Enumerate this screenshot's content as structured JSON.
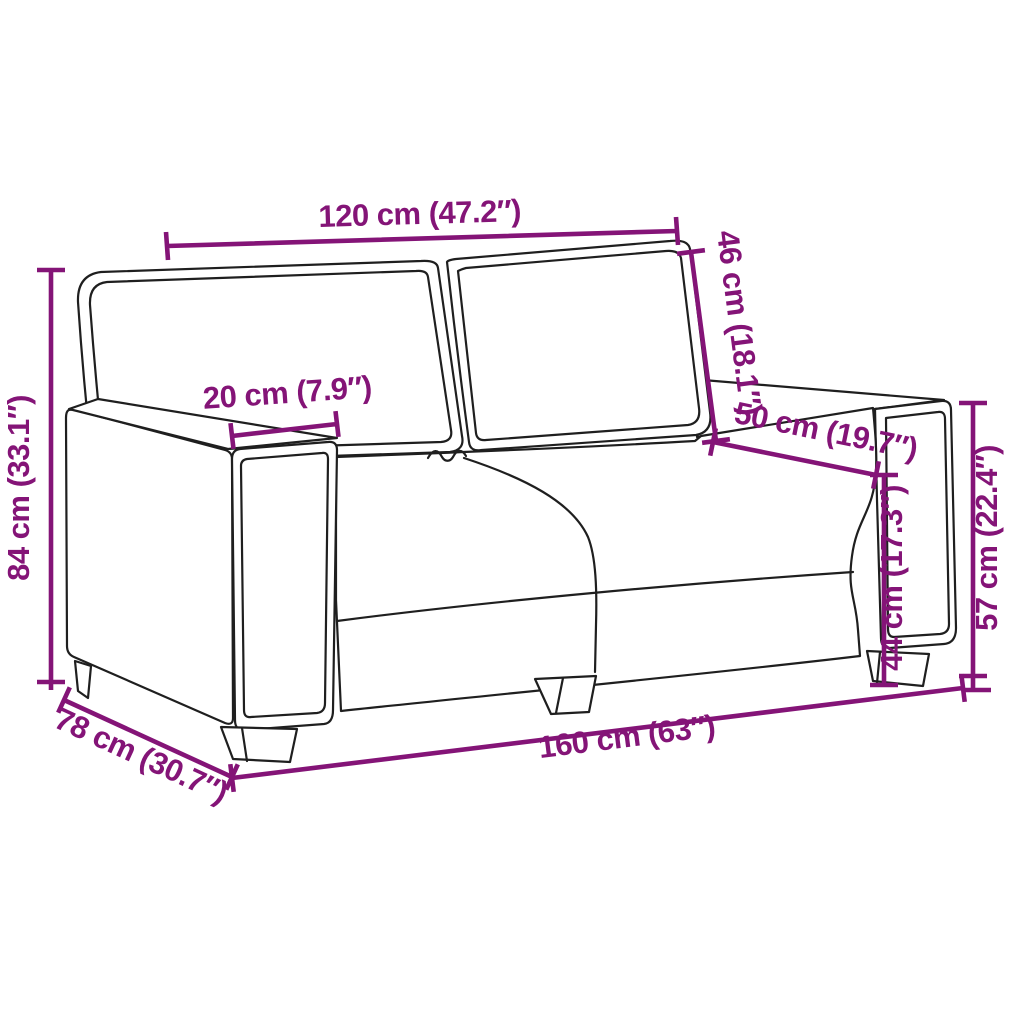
{
  "figure": {
    "subject": "two-seater sofa outline drawing with dimension annotations",
    "colors": {
      "background": "#ffffff",
      "outline": "#1f1f1f",
      "dimension_accent": "#841477"
    }
  },
  "dims": {
    "back_width": {
      "label": "120 cm (47.2″)",
      "cm": 120,
      "inch": 47.2
    },
    "back_height": {
      "label": "46 cm (18.1″)",
      "cm": 46,
      "inch": 18.1
    },
    "armrest_width": {
      "label": "20 cm (7.9″)",
      "cm": 20,
      "inch": 7.9
    },
    "seat_depth": {
      "label": "50 cm (19.7″)",
      "cm": 50,
      "inch": 19.7
    },
    "overall_height": {
      "label": "84 cm (33.1″)",
      "cm": 84,
      "inch": 33.1
    },
    "overall_depth": {
      "label": "78 cm (30.7″)",
      "cm": 78,
      "inch": 30.7
    },
    "overall_width": {
      "label": "160 cm (63″)",
      "cm": 160,
      "inch": 63
    },
    "armrest_height": {
      "label": "57 cm (22.4″)",
      "cm": 57,
      "inch": 22.4
    },
    "seat_height": {
      "label": "44 cm (17.3″)",
      "cm": 44,
      "inch": 17.3
    }
  }
}
